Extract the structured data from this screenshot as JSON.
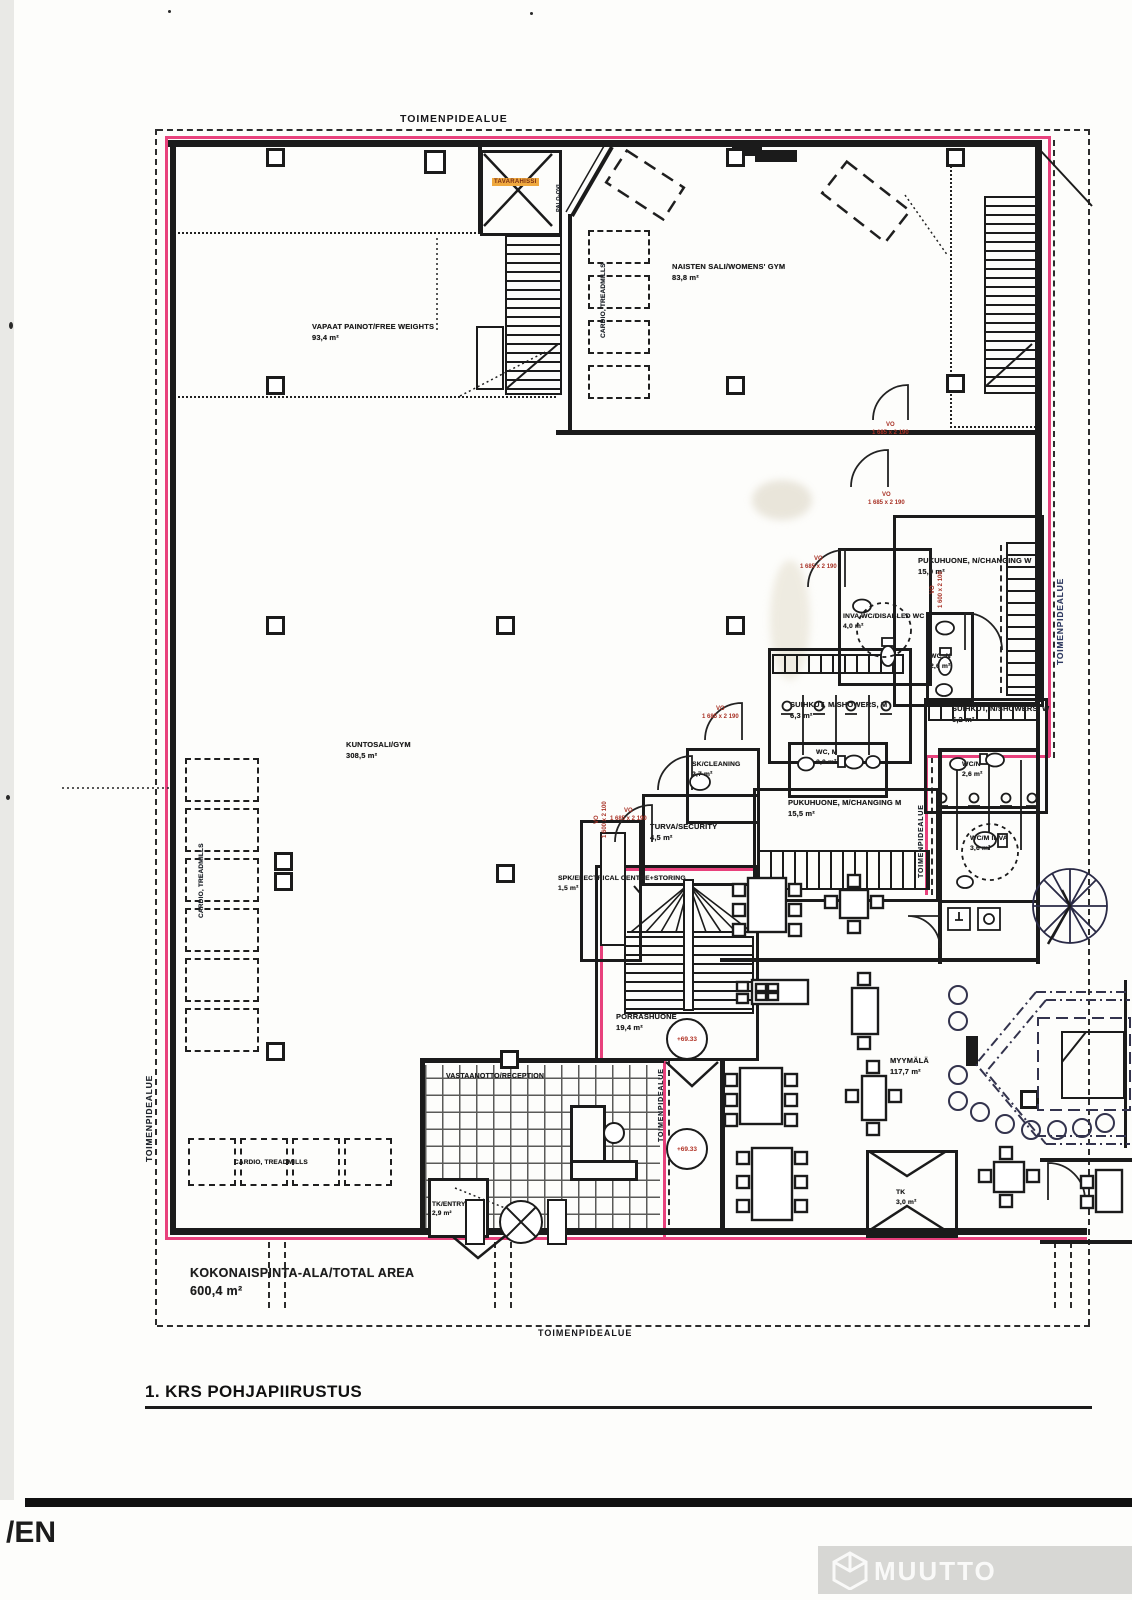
{
  "title": "1. KRS POHJAPIIRUSTUS",
  "footer_left_partial": "/EN",
  "footer_right_partial": "1. KRS OSAPO",
  "watermark_partial": "MUUTTO",
  "boundary_label": "TOIMENPIDEALUE",
  "total_area": {
    "label": "KOKONAISPINTA-ALA/TOTAL AREA",
    "value": "600,4 m²"
  },
  "elevation_marker": "+69.33",
  "door_tag": {
    "code": "VO",
    "size": "1 685 x 2 190"
  },
  "door_tag_vertical": {
    "code": "VO",
    "size": "1 600 x 2 100"
  },
  "equipment": {
    "elevator": "TAVARAHISSI",
    "fire_door": "PALO-OVI",
    "cardio": "CARDIO, TREADMILLS"
  },
  "colors": {
    "boundary_magenta": "#e8417c",
    "door_tag_red": "#a83226",
    "elevator_highlight": "#efa93f",
    "footer_blue": "#3f4c8c",
    "ink": "#1b1b1b"
  },
  "rooms": {
    "free_weights": {
      "name": "VAPAAT PAINOT/FREE WEIGHTS",
      "area": "93,4 m²"
    },
    "womens_gym": {
      "name": "NAISTEN SALI/WOMENS' GYM",
      "area": "83,8 m²"
    },
    "gym": {
      "name": "KUNTOSALI/GYM",
      "area": "308,5 m²"
    },
    "changing_w": {
      "name": "PUKUHUONE, N/CHANGING W",
      "area": "15,9 m²"
    },
    "disabled_wc": {
      "name": "INVA WC/DISABLED WC",
      "area": "4,0 m²"
    },
    "wc_n": {
      "name": "WC, N",
      "area": "2,6 m²"
    },
    "showers_m": {
      "name": "SUIHKUT, M/SHOWERS, M",
      "area": "6,3 m²"
    },
    "showers_w": {
      "name": "SUIHKUT, N/SHOWERS, W",
      "area": "6,2 m²"
    },
    "wc_m": {
      "name": "WC, M",
      "area": "2,0 m²"
    },
    "cleaning": {
      "name": "SK/CLEANING",
      "area": "2,7 m²"
    },
    "security": {
      "name": "TURVA/SECURITY",
      "area": "4,5 m²"
    },
    "changing_m": {
      "name": "PUKUHUONE, M/CHANGING M",
      "area": "15,5 m²"
    },
    "electrical": {
      "name": "SPK/ELECTRICAL CENTRE+STORING",
      "area": "1,5 m²"
    },
    "stairwell": {
      "name": "PORRASHUONE",
      "area": "19,4 m²"
    },
    "reception": {
      "name": "VASTAANOTTO/RECEPTION",
      "area": ""
    },
    "entry": {
      "name": "TK/ENTRY",
      "area": "2,9 m²"
    },
    "shop": {
      "name": "MYYMÄLÄ",
      "area": "117,7 m²"
    },
    "vestibule": {
      "name": "TK",
      "area": "3,0 m²"
    },
    "wc_n2": {
      "name": "WC/N",
      "area": "2,6 m²"
    },
    "wc_inva": {
      "name": "WC/M INVA",
      "area": "3,6 m²"
    }
  }
}
